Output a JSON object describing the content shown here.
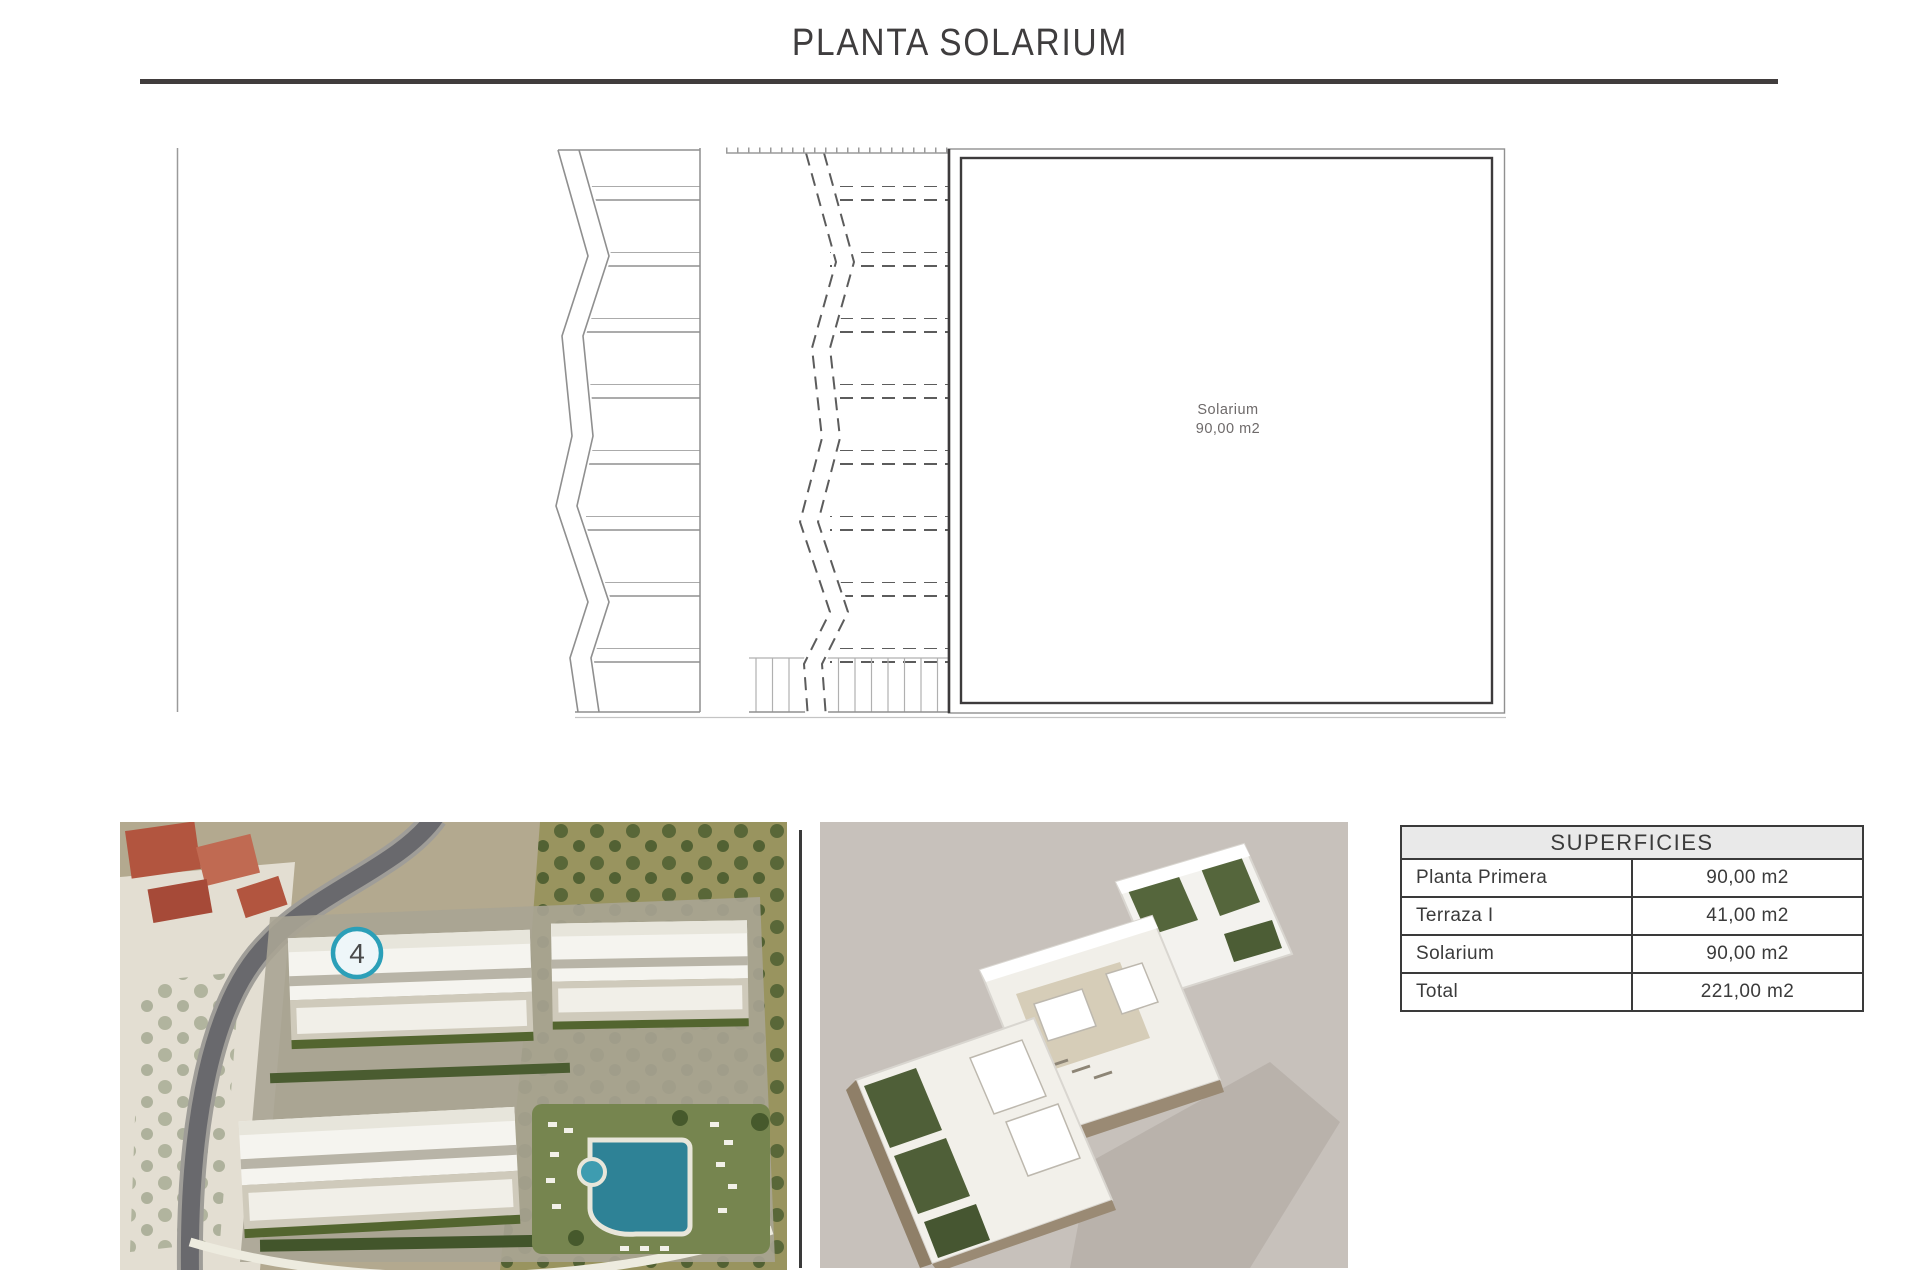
{
  "page": {
    "title": "PLANTA SOLARIUM"
  },
  "plan": {
    "room_name": "Solarium",
    "room_area": "90,00 m2"
  },
  "aerial": {
    "marker_label": "4"
  },
  "superficies_table": {
    "header": "SUPERFICIES",
    "rows": [
      {
        "label": "Planta Primera",
        "value": "90,00 m2"
      },
      {
        "label": "Terraza I",
        "value": "41,00 m2"
      },
      {
        "label": "Solarium",
        "value": "90,00 m2"
      },
      {
        "label": "Total",
        "value": "221,00 m2"
      }
    ]
  },
  "colors": {
    "accent_teal": "#2b9fb8",
    "line_gray": "#8f8f8f",
    "border_dark": "#3d3b3c",
    "table_header_bg": "#e9e9e9",
    "render_bg": "#c7c1bb"
  }
}
